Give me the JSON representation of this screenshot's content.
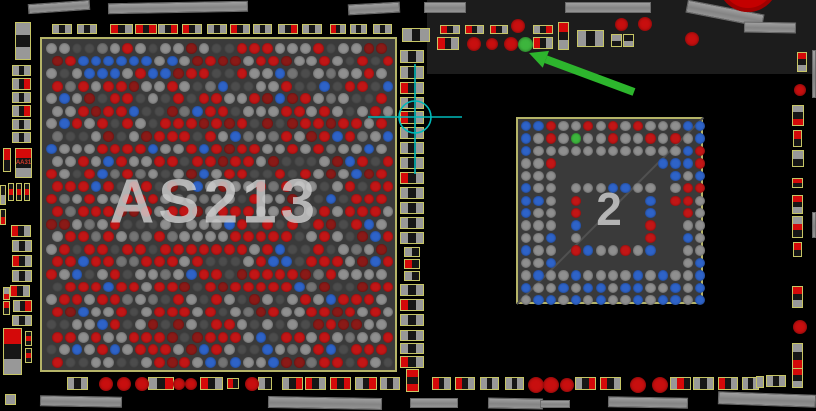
{
  "board": {
    "width": 816,
    "height": 411,
    "bg": "#000000"
  },
  "palette": {
    "chip_bg": "#3a3a3a",
    "chip_border": "#b5b468",
    "component_outline": "#c6c565",
    "segment_colors": {
      "g": "#989898",
      "d": "#161616",
      "r": "#d40909"
    },
    "ball_colors": {
      "r": "#c21616",
      "m": "#8a1a17",
      "g": "#8f8f8f",
      "h": "#747474",
      "d": "#4c4c4c",
      "b": "#2e63c8",
      "N": "#3db53d"
    },
    "via_red": "#c80f0f",
    "via_green": "#3db53d",
    "copper_gray": "#909090",
    "crosshair_cyan": "#00b9b9",
    "arrow_green": "#2db52d"
  },
  "regions": [
    [
      427,
      0,
      389,
      74,
      "#1c1c1c"
    ]
  ],
  "big_circle": {
    "cx": 748,
    "cy": -18,
    "r": 30
  },
  "chips": [
    {
      "id": "chip-as213",
      "label": "AS213",
      "x": 40,
      "y": 37,
      "w": 357,
      "h": 335,
      "label_size": 62,
      "label_spacing": 4,
      "diagonal": false,
      "balls": {
        "type": "staggered",
        "cols": 27,
        "rows": 26,
        "pitch_x": 12.7,
        "pitch_y": 12.55,
        "r": 5.4,
        "offset_x": 49.5,
        "offset_y": 46.5,
        "seed": 11,
        "weights": [
          [
            "r",
            0.34
          ],
          [
            "g",
            0.25
          ],
          [
            "d",
            0.15
          ],
          [
            "m",
            0.11
          ],
          [
            "h",
            0.07
          ],
          [
            "b",
            0.08
          ]
        ],
        "blue_cluster": {
          "rows": [
            1,
            2
          ],
          "col_min": 2,
          "col_max": 9,
          "p": 0.7
        }
      }
    },
    {
      "id": "chip-2",
      "label": "2",
      "x": 516,
      "y": 117,
      "w": 187,
      "h": 187,
      "label_size": 46,
      "label_spacing": 0,
      "diagonal": true,
      "balls": {
        "type": "grid",
        "pitch": 12.45,
        "r": 5.2,
        "offset_x": 524,
        "offset_y": 124,
        "rows": [
          "bbrggrgrgrgggbb",
          "bgrgNggrggrgrgb",
          "bggggggggggggbr",
          "ggr........bbbr",
          "ggg.........bgb",
          "bgg.gggbbgg.grr",
          "bbg.r.....b.rrg",
          "bgg.r.....b..rg",
          "ggg.b.....r..gg",
          "ggb.g.....r..bg",
          "bgg.rbggrgb..gg",
          "ggb..........gb",
          "gbggbggggbgbggb",
          "bggbgbbgbbggbgb",
          "gbbgbgbggbgbbgb"
        ]
      }
    }
  ],
  "components": [
    [
      15,
      22,
      16,
      38,
      "v",
      "g,d,g"
    ],
    [
      52,
      24,
      20,
      10,
      "h",
      "g,d,g"
    ],
    [
      77,
      24,
      20,
      10,
      "h",
      "g,d,g"
    ],
    [
      110,
      24,
      23,
      10,
      "h",
      "r,d,g"
    ],
    [
      135,
      24,
      22,
      10,
      "h",
      "r,d,r"
    ],
    [
      158,
      24,
      20,
      10,
      "h",
      "g,d,r"
    ],
    [
      182,
      24,
      20,
      10,
      "h",
      "r,d,g"
    ],
    [
      207,
      24,
      20,
      10,
      "h",
      "g,d,g"
    ],
    [
      230,
      24,
      20,
      10,
      "h",
      "r,d,g"
    ],
    [
      253,
      24,
      19,
      10,
      "h",
      "g,d,g"
    ],
    [
      278,
      24,
      20,
      10,
      "h",
      "g,d,r"
    ],
    [
      302,
      24,
      20,
      10,
      "h",
      "g,d,g"
    ],
    [
      330,
      24,
      16,
      10,
      "h",
      "r,d,g"
    ],
    [
      350,
      24,
      17,
      10,
      "h",
      "g,d,g"
    ],
    [
      373,
      24,
      19,
      10,
      "h",
      "g,d,g"
    ],
    [
      402,
      28,
      28,
      14,
      "h",
      "g,d,g"
    ],
    [
      12,
      65,
      19,
      11,
      "h",
      "g,d,g"
    ],
    [
      12,
      78,
      19,
      12,
      "h",
      "g,d,r"
    ],
    [
      12,
      92,
      19,
      11,
      "h",
      "g,d,g"
    ],
    [
      12,
      105,
      19,
      12,
      "h",
      "g,d,r"
    ],
    [
      12,
      119,
      19,
      11,
      "h",
      "g,d,g"
    ],
    [
      12,
      132,
      19,
      11,
      "h",
      "g,d,g"
    ],
    [
      3,
      148,
      8,
      24,
      "v",
      "r,d"
    ],
    [
      15,
      148,
      17,
      30,
      "v",
      "r,d,g",
      "AA31"
    ],
    [
      8,
      183,
      6,
      18,
      "v",
      "d,r,d"
    ],
    [
      16,
      183,
      6,
      18,
      "v",
      "d,r,d"
    ],
    [
      24,
      183,
      6,
      18,
      "v",
      "d,r,d"
    ],
    [
      11,
      225,
      20,
      12,
      "h",
      "r,d,g"
    ],
    [
      12,
      240,
      20,
      12,
      "h",
      "g,d,g"
    ],
    [
      12,
      255,
      20,
      12,
      "h",
      "r,d,g"
    ],
    [
      12,
      270,
      20,
      12,
      "h",
      "g,d,g"
    ],
    [
      10,
      285,
      20,
      12,
      "h",
      "r,d,g"
    ],
    [
      13,
      300,
      19,
      12,
      "h",
      "g,d,r"
    ],
    [
      12,
      315,
      20,
      11,
      "h",
      "g,d,g"
    ],
    [
      3,
      287,
      7,
      13,
      "v",
      "g,r"
    ],
    [
      3,
      301,
      7,
      14,
      "v",
      "r,d"
    ],
    [
      3,
      328,
      19,
      47,
      "v",
      "r,d,g"
    ],
    [
      25,
      331,
      7,
      15,
      "v",
      "d,r,d"
    ],
    [
      25,
      348,
      7,
      15,
      "v",
      "d,r,d"
    ],
    [
      5,
      394,
      11,
      11,
      "h",
      "g"
    ],
    [
      0,
      185,
      6,
      20,
      "v",
      "d,g"
    ],
    [
      0,
      209,
      6,
      16,
      "v",
      "d,r"
    ],
    [
      400,
      50,
      24,
      13,
      "h",
      "g,d,g"
    ],
    [
      400,
      66,
      24,
      13,
      "h",
      "g,d,g"
    ],
    [
      400,
      82,
      24,
      12,
      "h",
      "r,d,g"
    ],
    [
      400,
      97,
      24,
      12,
      "h",
      "g,d,g"
    ],
    [
      400,
      111,
      24,
      13,
      "h",
      "r,d,g"
    ],
    [
      400,
      127,
      24,
      12,
      "h",
      "g,d,g"
    ],
    [
      400,
      142,
      24,
      12,
      "h",
      "g,d,g"
    ],
    [
      400,
      157,
      24,
      12,
      "h",
      "g,d,g"
    ],
    [
      400,
      172,
      24,
      12,
      "h",
      "r,d,g"
    ],
    [
      400,
      187,
      24,
      12,
      "h",
      "g,d,g"
    ],
    [
      400,
      202,
      24,
      12,
      "h",
      "g,d,g"
    ],
    [
      400,
      217,
      24,
      12,
      "h",
      "g,d,g"
    ],
    [
      400,
      232,
      24,
      12,
      "h",
      "g,d,g"
    ],
    [
      404,
      247,
      16,
      10,
      "h",
      "g,d"
    ],
    [
      404,
      259,
      16,
      10,
      "h",
      "r,d"
    ],
    [
      404,
      271,
      16,
      10,
      "h",
      "g,d"
    ],
    [
      400,
      284,
      24,
      12,
      "h",
      "g,d,g"
    ],
    [
      400,
      299,
      24,
      12,
      "h",
      "r,d,g"
    ],
    [
      400,
      314,
      24,
      12,
      "h",
      "g,d,g"
    ],
    [
      400,
      330,
      24,
      11,
      "h",
      "g,d,g"
    ],
    [
      400,
      343,
      24,
      11,
      "h",
      "g,d,g"
    ],
    [
      400,
      356,
      24,
      12,
      "h",
      "r,d,g"
    ],
    [
      406,
      369,
      13,
      23,
      "v",
      "r,d,r"
    ],
    [
      440,
      25,
      20,
      9,
      "h",
      "r,d,g"
    ],
    [
      465,
      25,
      19,
      9,
      "h",
      "r,d,g"
    ],
    [
      490,
      25,
      18,
      9,
      "h",
      "r,d,g"
    ],
    [
      533,
      25,
      20,
      9,
      "h",
      "g,d,r"
    ],
    [
      437,
      37,
      22,
      13,
      "h",
      "r,d,g"
    ],
    [
      533,
      37,
      20,
      12,
      "h",
      "r,d,g"
    ],
    [
      558,
      22,
      11,
      28,
      "v",
      "r,d,g"
    ],
    [
      577,
      30,
      27,
      17,
      "h",
      "g,d,g"
    ],
    [
      611,
      34,
      11,
      13,
      "v",
      "g,d"
    ],
    [
      623,
      34,
      11,
      13,
      "v",
      "d,g"
    ],
    [
      67,
      377,
      21,
      13,
      "h",
      "g,d,g"
    ],
    [
      148,
      377,
      26,
      13,
      "h",
      "g,d,r"
    ],
    [
      200,
      377,
      23,
      13,
      "h",
      "r,d,g"
    ],
    [
      227,
      378,
      12,
      11,
      "h",
      "r,d"
    ],
    [
      258,
      377,
      14,
      13,
      "h",
      "g,d"
    ],
    [
      282,
      377,
      21,
      13,
      "h",
      "g,d,r"
    ],
    [
      305,
      377,
      21,
      13,
      "h",
      "r,d,g"
    ],
    [
      330,
      377,
      21,
      13,
      "h",
      "r,d,r"
    ],
    [
      355,
      377,
      22,
      13,
      "h",
      "g,d,r"
    ],
    [
      380,
      377,
      20,
      13,
      "h",
      "g,d,g"
    ],
    [
      432,
      377,
      19,
      13,
      "h",
      "r,d,g"
    ],
    [
      455,
      377,
      20,
      13,
      "h",
      "r,d,g"
    ],
    [
      480,
      377,
      19,
      13,
      "h",
      "g,d,g"
    ],
    [
      505,
      377,
      19,
      13,
      "h",
      "g,d,g"
    ],
    [
      575,
      377,
      21,
      13,
      "h",
      "g,d,r"
    ],
    [
      600,
      377,
      21,
      13,
      "h",
      "r,d,g"
    ],
    [
      670,
      377,
      21,
      13,
      "h",
      "g,r,d"
    ],
    [
      693,
      377,
      21,
      13,
      "h",
      "g,d,g"
    ],
    [
      718,
      377,
      20,
      13,
      "h",
      "r,d,g"
    ],
    [
      742,
      377,
      17,
      13,
      "h",
      "g,d,g"
    ],
    [
      756,
      376,
      8,
      12,
      "h",
      "g"
    ],
    [
      766,
      375,
      20,
      12,
      "h",
      "g,d,g"
    ],
    [
      797,
      52,
      10,
      20,
      "v",
      "r,d,g"
    ],
    [
      792,
      105,
      12,
      21,
      "v",
      "g,d,r"
    ],
    [
      793,
      130,
      9,
      17,
      "v",
      "r,d"
    ],
    [
      792,
      150,
      12,
      17,
      "v",
      "g,d"
    ],
    [
      792,
      178,
      11,
      10,
      "v",
      "r,d"
    ],
    [
      792,
      195,
      11,
      19,
      "v",
      "r,d,g"
    ],
    [
      792,
      216,
      11,
      22,
      "v",
      "g,r,d"
    ],
    [
      793,
      242,
      9,
      15,
      "v",
      "r,d"
    ],
    [
      792,
      286,
      11,
      22,
      "v",
      "r,d,g"
    ],
    [
      792,
      343,
      11,
      26,
      "v",
      "g,d,r"
    ],
    [
      792,
      368,
      11,
      20,
      "v",
      "r,d,g"
    ]
  ],
  "vias": [
    [
      518,
      26,
      7,
      "red"
    ],
    [
      621,
      24,
      6.5,
      "red"
    ],
    [
      645,
      24,
      7,
      "red"
    ],
    [
      692,
      39,
      7,
      "red"
    ],
    [
      474,
      44,
      7,
      "red"
    ],
    [
      492,
      44,
      6,
      "red"
    ],
    [
      511,
      44,
      7,
      "red"
    ],
    [
      525,
      44,
      7.5,
      "green"
    ],
    [
      800,
      90,
      6,
      "red"
    ],
    [
      800,
      327,
      7,
      "red"
    ],
    [
      106,
      384,
      7,
      "red"
    ],
    [
      124,
      384,
      7,
      "red"
    ],
    [
      142,
      384,
      7,
      "red"
    ],
    [
      179,
      384,
      6,
      "red"
    ],
    [
      191,
      384,
      6,
      "red"
    ],
    [
      252,
      384,
      7,
      "red"
    ],
    [
      536,
      385,
      8,
      "red"
    ],
    [
      551,
      385,
      8,
      "red"
    ],
    [
      567,
      385,
      7,
      "red"
    ],
    [
      638,
      385,
      8,
      "red"
    ],
    [
      660,
      385,
      8,
      "red"
    ]
  ],
  "bars": [
    [
      28,
      2,
      62,
      10,
      -4
    ],
    [
      108,
      2,
      140,
      11,
      -1
    ],
    [
      348,
      3,
      52,
      11,
      -3
    ],
    [
      424,
      2,
      42,
      11,
      0
    ],
    [
      565,
      2,
      86,
      11,
      0
    ],
    [
      686,
      7,
      78,
      13,
      11
    ],
    [
      744,
      22,
      52,
      11,
      1
    ],
    [
      40,
      396,
      82,
      11,
      1
    ],
    [
      268,
      397,
      114,
      12,
      1
    ],
    [
      410,
      398,
      48,
      10,
      0
    ],
    [
      488,
      398,
      55,
      11,
      1
    ],
    [
      540,
      400,
      30,
      8,
      0
    ],
    [
      608,
      397,
      80,
      11,
      1
    ],
    [
      718,
      393,
      98,
      13,
      2
    ],
    [
      812,
      50,
      4,
      48,
      0
    ],
    [
      812,
      212,
      4,
      26,
      0
    ]
  ],
  "annotations": {
    "crosshair": {
      "cx": 415,
      "cy": 117,
      "r": 16,
      "h_x1": 368,
      "h_x2": 462,
      "v_y1": 64,
      "v_y2": 174
    },
    "arrow": {
      "x1": 634,
      "y1": 92,
      "x2": 529,
      "y2": 53,
      "width": 8
    }
  }
}
